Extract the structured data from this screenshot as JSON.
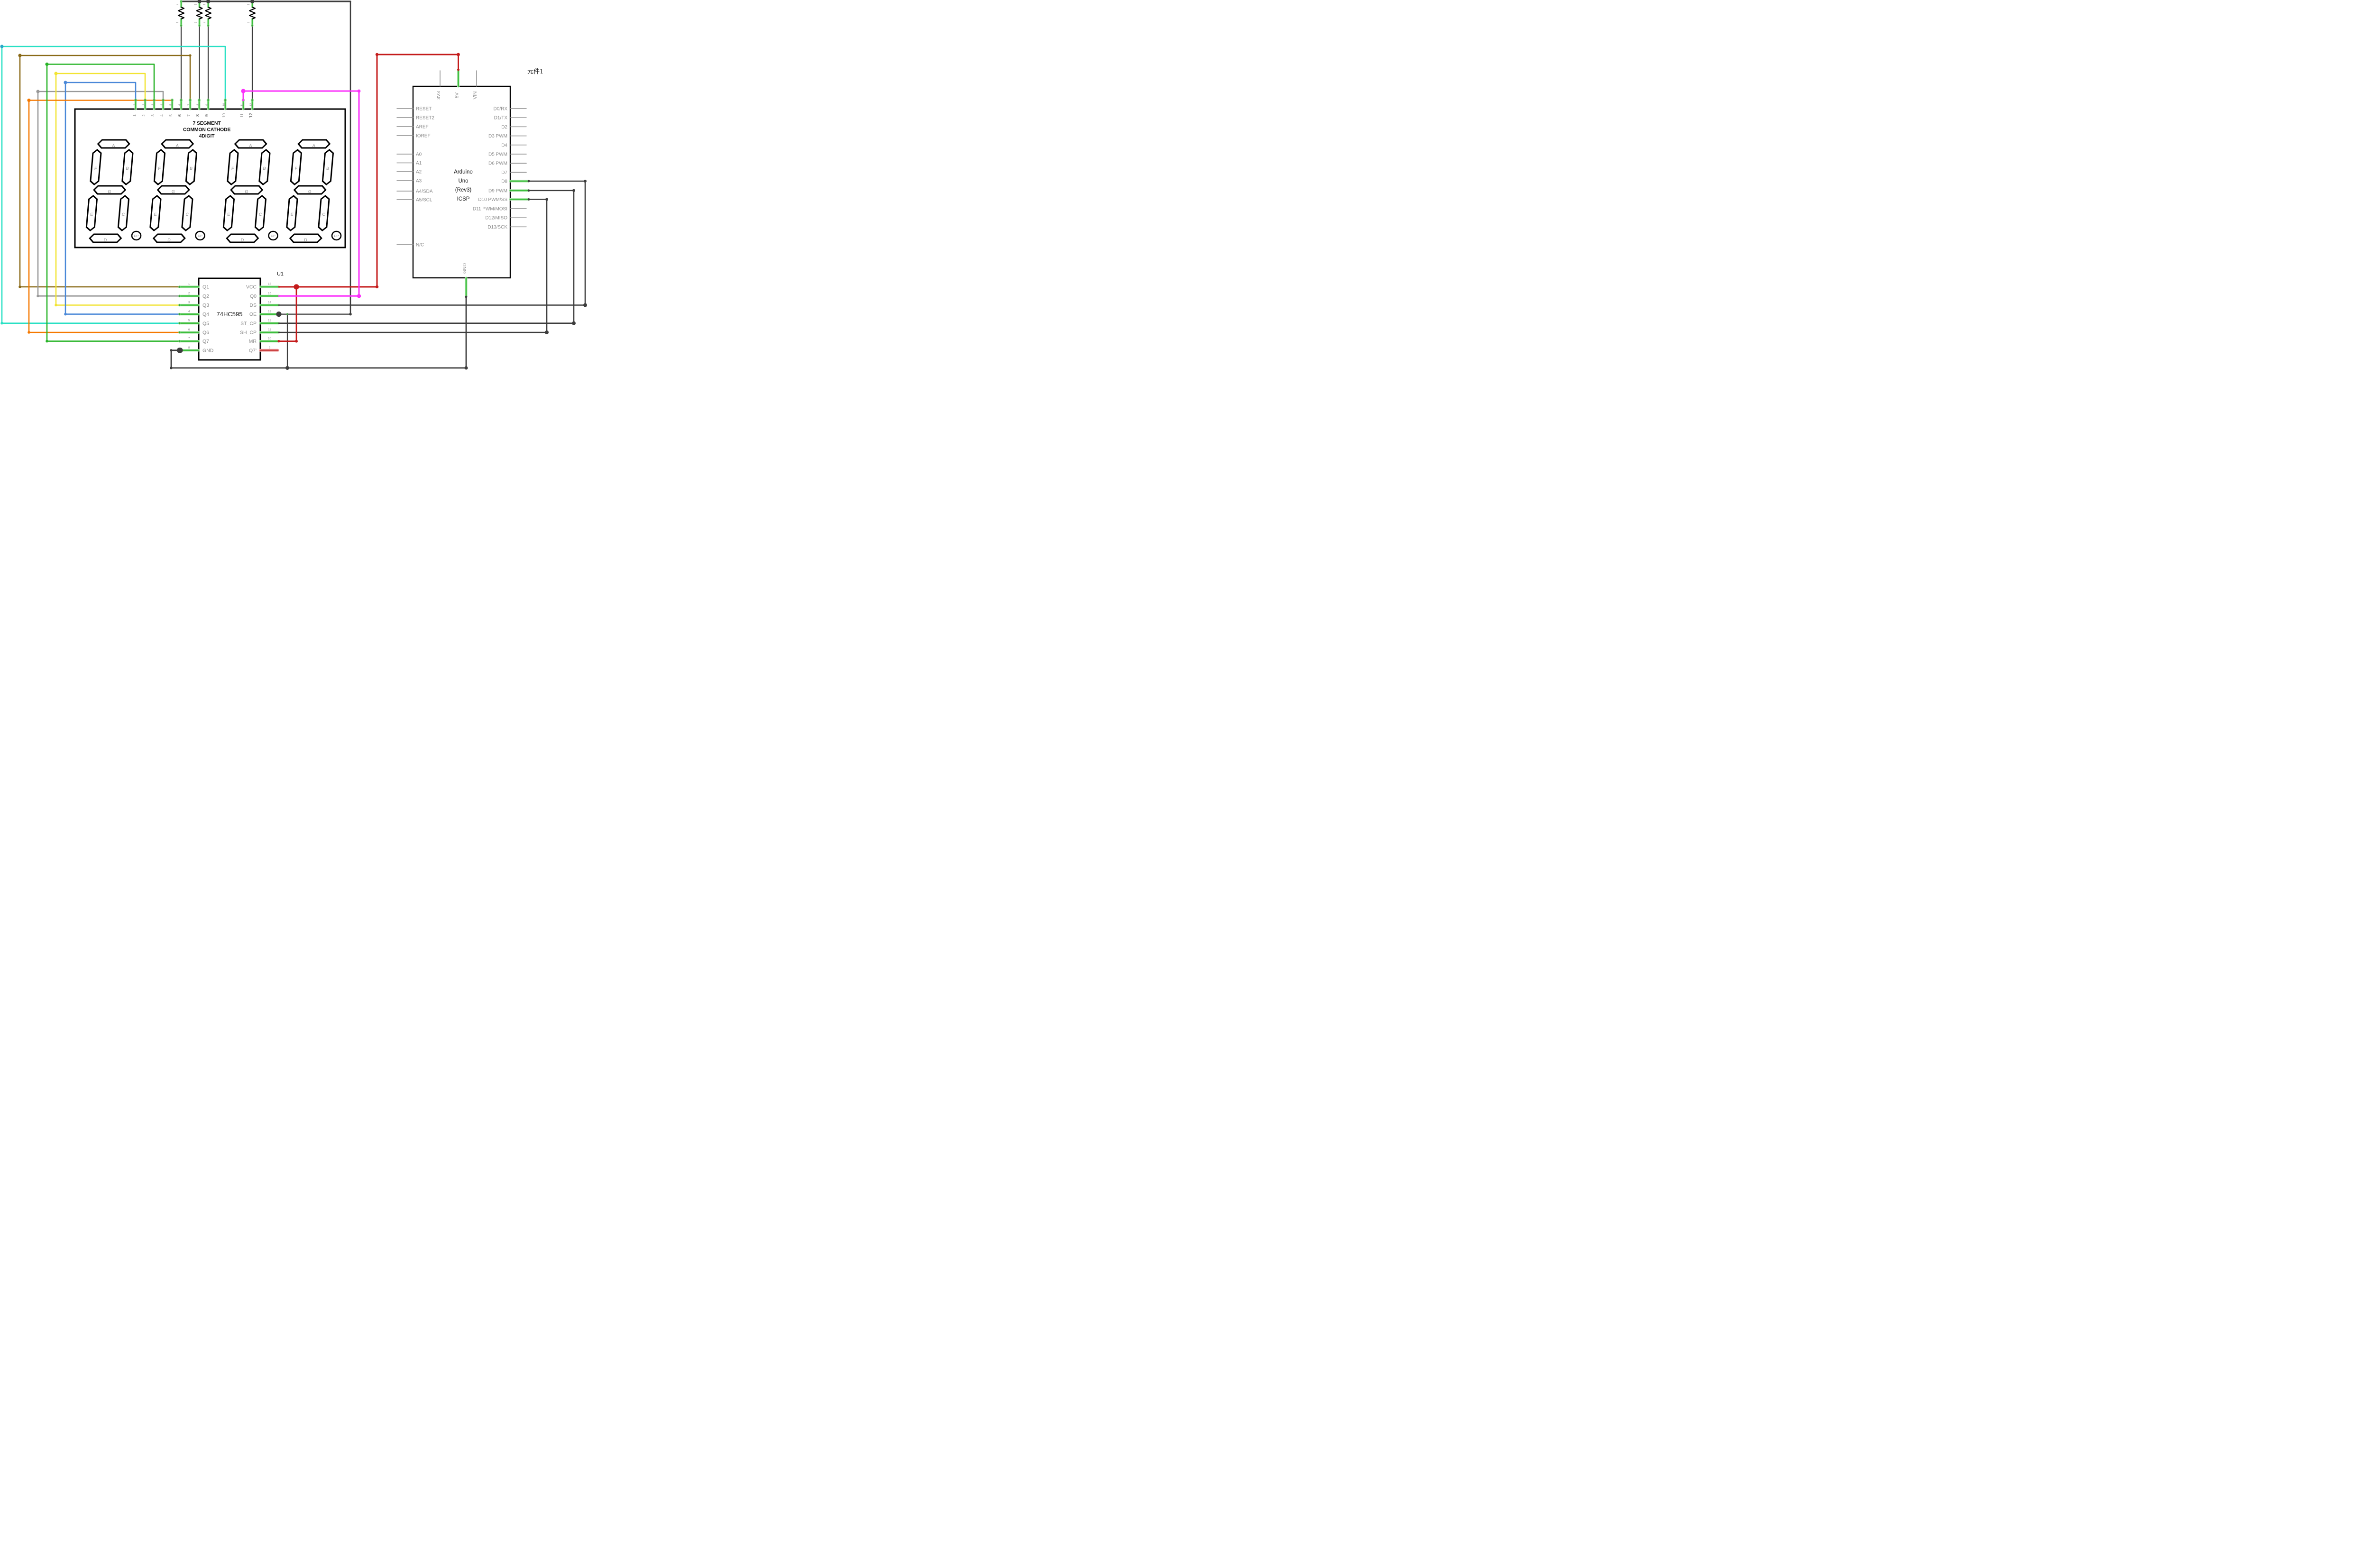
{
  "app": {
    "component_label": "元件1"
  },
  "display": {
    "title_lines": [
      "7 SEGMENT",
      "COMMON CATHODE",
      "4DIGIT"
    ],
    "pin_numbers": [
      "1",
      "2",
      "3",
      "4",
      "5",
      "6",
      "7",
      "8",
      "9",
      "10",
      "11",
      "12"
    ],
    "common_cathode_pins": [
      "6",
      "8",
      "9",
      "12"
    ],
    "segment_labels": [
      "A",
      "B",
      "C",
      "D",
      "E",
      "F",
      "G"
    ],
    "dp_label": "DP",
    "digit_count": 4
  },
  "resistors": [
    {
      "pin_top": "2",
      "pin_bottom": "1"
    },
    {
      "pin_top": "1",
      "pin_bottom": "2"
    },
    {
      "pin_top": "1",
      "pin_bottom": "2"
    },
    {
      "pin_top": "1",
      "pin_bottom": "2"
    }
  ],
  "shift_register": {
    "designator": "U1",
    "part_number": "74HC595",
    "left_pins": [
      {
        "num": "1",
        "label": "Q1"
      },
      {
        "num": "2",
        "label": "Q2"
      },
      {
        "num": "3",
        "label": "Q3"
      },
      {
        "num": "4",
        "label": "Q4"
      },
      {
        "num": "5",
        "label": "Q5"
      },
      {
        "num": "6",
        "label": "Q6"
      },
      {
        "num": "7",
        "label": "Q7"
      },
      {
        "num": "8",
        "label": "GND"
      }
    ],
    "right_pins": [
      {
        "num": "16",
        "label": "VCC"
      },
      {
        "num": "15",
        "label": "Q0"
      },
      {
        "num": "14",
        "label": "DS"
      },
      {
        "num": "13",
        "label": "OE"
      },
      {
        "num": "12",
        "label": "ST_CP"
      },
      {
        "num": "11",
        "label": "SH_CP"
      },
      {
        "num": "10",
        "label": "MR"
      },
      {
        "num": "9",
        "label": "Q7'"
      }
    ]
  },
  "arduino": {
    "title_lines": [
      "Arduino",
      "Uno",
      "(Rev3)",
      "ICSP"
    ],
    "top_pins": [
      "3V3",
      "5V",
      "VIN"
    ],
    "bottom_pins": [
      "GND"
    ],
    "left_pins": [
      "RESET",
      "RESET2",
      "AREF",
      "IOREF",
      "A0",
      "A1",
      "A2",
      "A3",
      "A4/SDA",
      "A5/SCL",
      "N/C"
    ],
    "right_pins": [
      "D0/RX",
      "D1/TX",
      "D2",
      "D3 PWM",
      "D4",
      "D5 PWM",
      "D6 PWM",
      "D7",
      "D8",
      "D9 PWM",
      "D10 PWM/SS",
      "D11 PWM/MOSI",
      "D12/MISO",
      "D13/SCK"
    ]
  },
  "colors": {
    "wire_dark": "#3d3d3d",
    "wire_red": "#c41b1b",
    "wire_magenta": "#fb30fb",
    "wire_cyan": "#29e0c4",
    "wire_brown": "#8a6a18",
    "wire_green": "#28b428",
    "wire_yellow": "#f2e433",
    "wire_blue": "#4a88d8",
    "wire_gray": "#999999",
    "wire_orange": "#f57900",
    "lead_green": "#3dbe3d",
    "lead_glow": "#b5e8b5",
    "lead_dot": "#5ed65e",
    "stub_gray": "#8c8c8c",
    "unconnected_red": "#cc4444",
    "unconnected_glow": "#f2b0b0",
    "label_gray": "#8c8c8c",
    "number_gray": "#909090",
    "ink": "#000000"
  }
}
